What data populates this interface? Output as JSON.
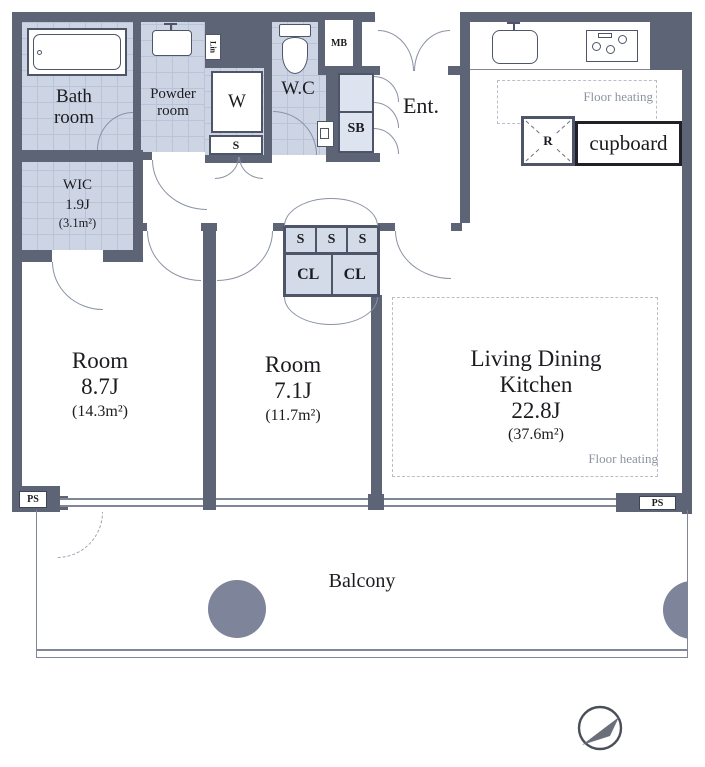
{
  "palette": {
    "wall": "#5d6476",
    "wet_area": "#cdd5e5",
    "outline": "#7e8698",
    "pillar": "#7e8499",
    "text": "#1b1c20",
    "muted_text": "#8d93a0"
  },
  "labels": {
    "bath_1": "Bath",
    "bath_2": "room",
    "powder_1": "Powder",
    "powder_2": "room",
    "lin": "Lin",
    "washer": "W",
    "storage_small": "S",
    "wc": "W.C",
    "mb": "MB",
    "sb": "SB",
    "ent": "Ent.",
    "wic_1": "WIC",
    "wic_2": "1.9J",
    "wic_3": "(3.1m²)",
    "s_a": "S",
    "s_b": "S",
    "s_c": "S",
    "cl_a": "CL",
    "cl_b": "CL",
    "fh_kitchen": "Floor heating",
    "fh_ldk": "Floor heating",
    "fridge": "R",
    "cupboard": "cupboard",
    "room1_1": "Room",
    "room1_2": "8.7J",
    "room1_3": "(14.3m²)",
    "room2_1": "Room",
    "room2_2": "7.1J",
    "room2_3": "(11.7m²)",
    "ldk_1": "Living Dining",
    "ldk_2": "Kitchen",
    "ldk_3": "22.8J",
    "ldk_4": "(37.6m²)",
    "ps_left": "PS",
    "ps_right": "PS",
    "balcony": "Balcony"
  }
}
